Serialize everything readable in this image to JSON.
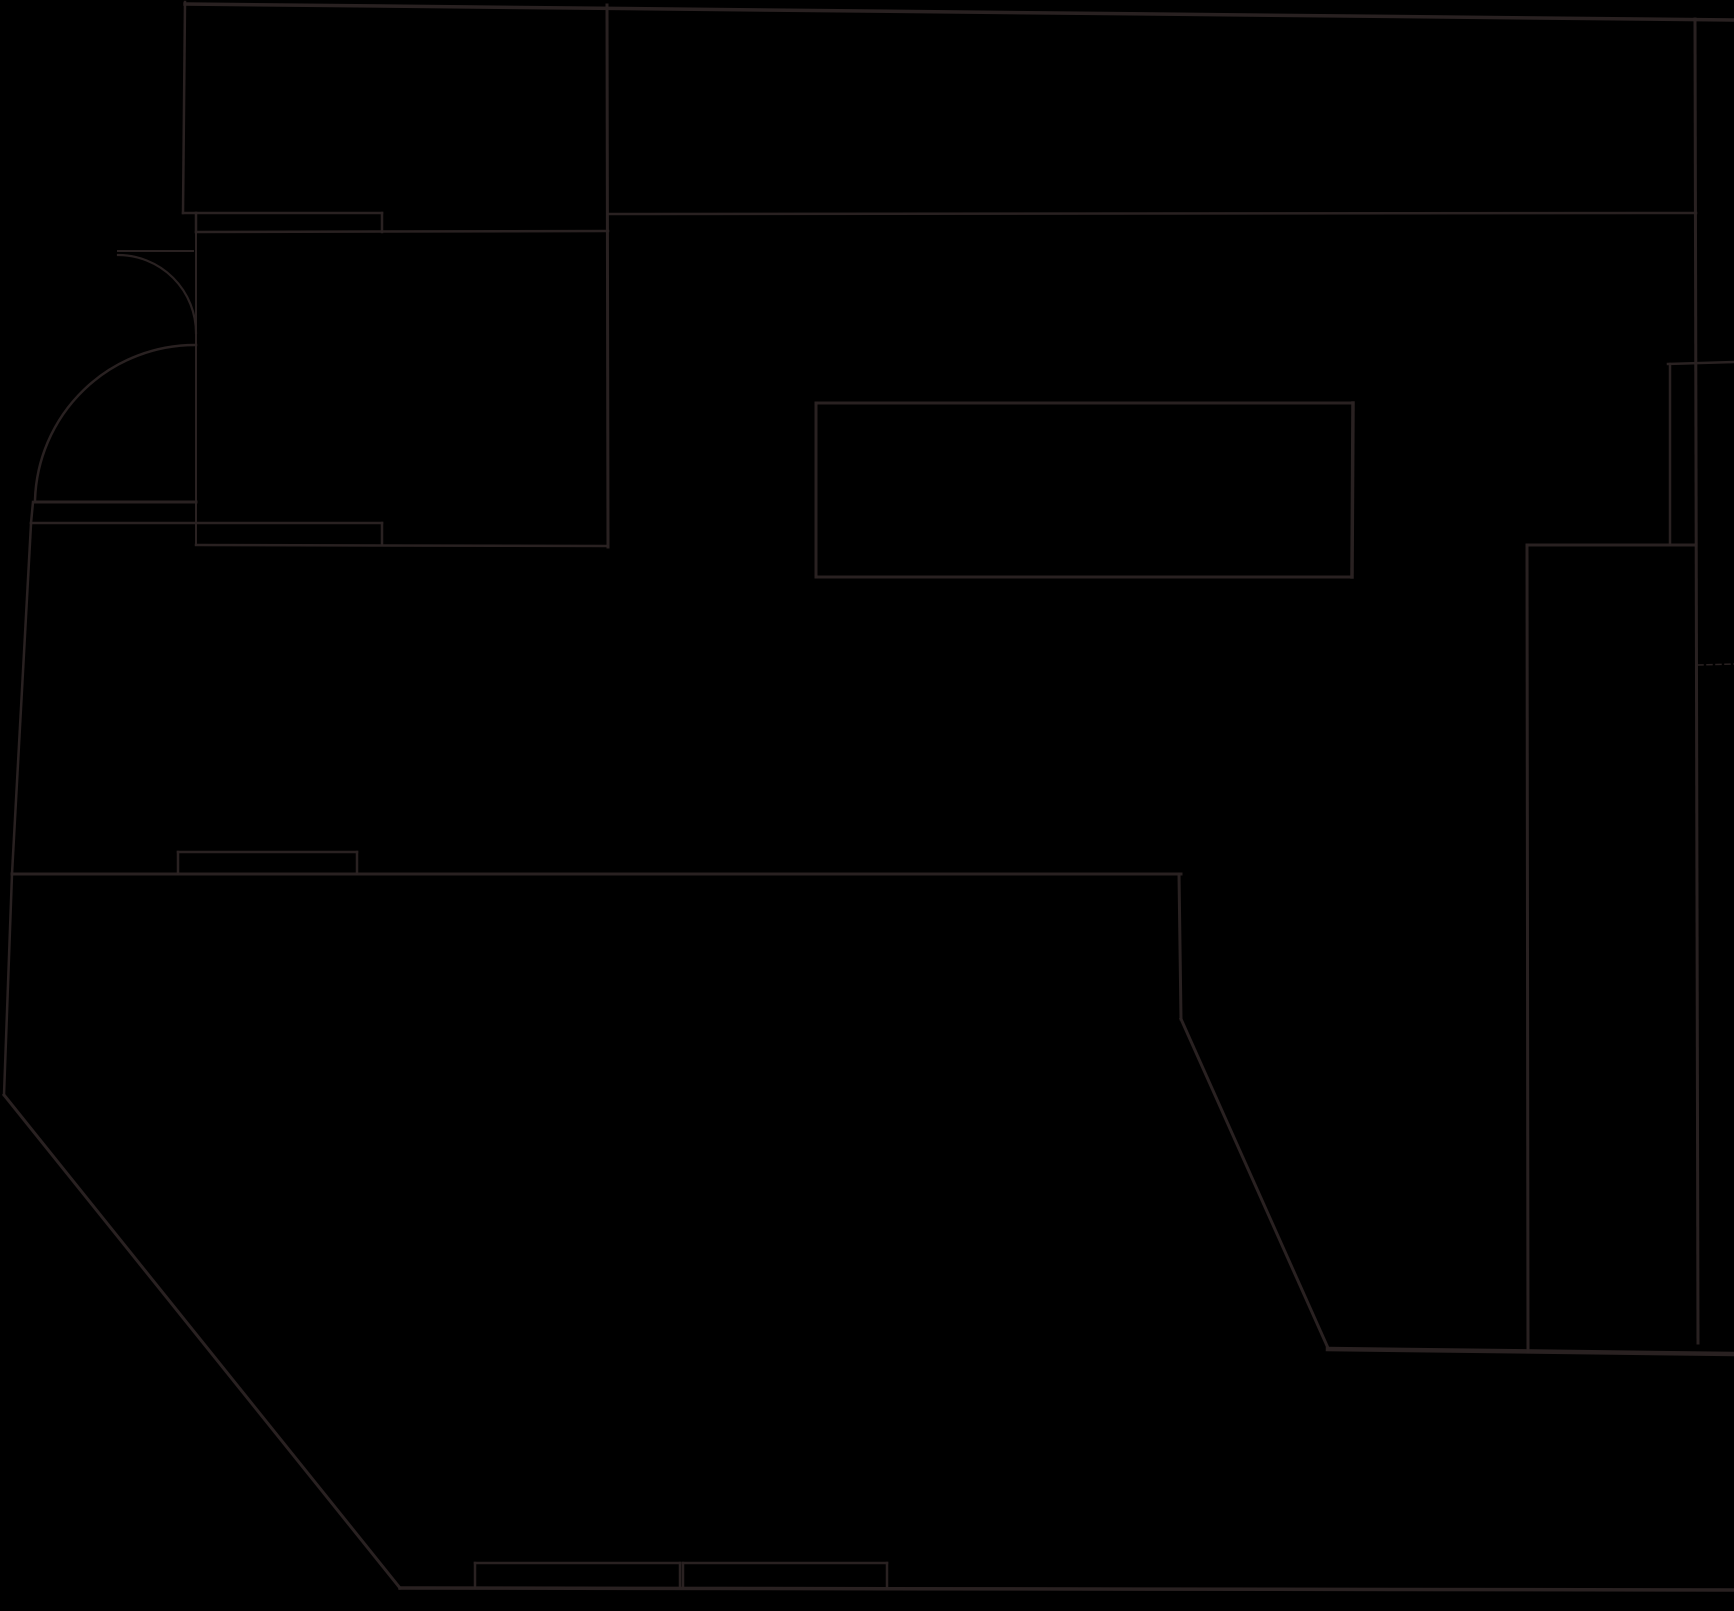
{
  "canvas": {
    "width": 1734,
    "height": 1611,
    "background_color": "#000000",
    "line_color": "#2b2222",
    "line_opacity": 0.96
  },
  "floor_plan": {
    "description": "single-line architectural floor plan, black background, faint dark strokes",
    "segments": [
      {
        "id": "upper-left-room-left-wall",
        "x1": 185,
        "y1": 2,
        "x2": 183,
        "y2": 213,
        "w": 2.5
      },
      {
        "id": "upper-left-jog",
        "x1": 183,
        "y1": 213,
        "x2": 196,
        "y2": 213,
        "w": 2.5
      },
      {
        "id": "window1-top",
        "x1": 196,
        "y1": 213,
        "x2": 382,
        "y2": 213,
        "w": 2.5
      },
      {
        "id": "window1-left-cap",
        "x1": 196,
        "y1": 213,
        "x2": 196,
        "y2": 232,
        "w": 2.5
      },
      {
        "id": "window1-right-cap",
        "x1": 382,
        "y1": 213,
        "x2": 382,
        "y2": 232,
        "w": 2.5
      },
      {
        "id": "wall-y231",
        "x1": 196,
        "y1": 232,
        "x2": 608,
        "y2": 231,
        "w": 2.5
      },
      {
        "id": "top-edge",
        "x1": 185,
        "y1": 4,
        "x2": 1734,
        "y2": 20,
        "w": 3.5
      },
      {
        "id": "vertical-607",
        "x1": 607,
        "y1": 5,
        "x2": 608,
        "y2": 547,
        "w": 3
      },
      {
        "id": "wall-y213-right",
        "x1": 608,
        "y1": 214,
        "x2": 1696,
        "y2": 213,
        "w": 2.5
      },
      {
        "id": "entry-wall-vertical-196",
        "x1": 196,
        "y1": 232,
        "x2": 196,
        "y2": 523,
        "w": 2
      },
      {
        "id": "door-leaf-upper",
        "x1": 118,
        "y1": 251,
        "x2": 193,
        "y2": 251,
        "w": 2
      },
      {
        "id": "entry-floor-y502",
        "x1": 35,
        "y1": 502,
        "x2": 196,
        "y2": 502,
        "w": 3
      },
      {
        "id": "entry-left-vertical",
        "x1": 33,
        "y1": 502,
        "x2": 31,
        "y2": 523,
        "w": 2.5
      },
      {
        "id": "wall-y523",
        "x1": 31,
        "y1": 523,
        "x2": 382,
        "y2": 523,
        "w": 2.5
      },
      {
        "id": "window2-mid-cap",
        "x1": 196,
        "y1": 523,
        "x2": 196,
        "y2": 545,
        "w": 2
      },
      {
        "id": "window2-right-cap",
        "x1": 382,
        "y1": 523,
        "x2": 382,
        "y2": 545,
        "w": 2.5
      },
      {
        "id": "wall-y545",
        "x1": 196,
        "y1": 545,
        "x2": 608,
        "y2": 546,
        "w": 2.5
      },
      {
        "id": "left-outer-wall-mid",
        "x1": 31,
        "y1": 524,
        "x2": 12,
        "y2": 874,
        "w": 2.5
      },
      {
        "id": "main-horizontal-y874",
        "x1": 12,
        "y1": 874,
        "x2": 1181,
        "y2": 874,
        "w": 3
      },
      {
        "id": "window3-top",
        "x1": 178,
        "y1": 852,
        "x2": 357,
        "y2": 852,
        "w": 2.5
      },
      {
        "id": "window3-left-cap",
        "x1": 178,
        "y1": 852,
        "x2": 178,
        "y2": 874,
        "w": 2.5
      },
      {
        "id": "window3-right-cap",
        "x1": 357,
        "y1": 852,
        "x2": 357,
        "y2": 874,
        "w": 2.5
      },
      {
        "id": "left-outer-wall-low",
        "x1": 12,
        "y1": 874,
        "x2": 4,
        "y2": 1095,
        "w": 2.5
      },
      {
        "id": "southwest-diagonal",
        "x1": 4,
        "y1": 1095,
        "x2": 400,
        "y2": 1588,
        "w": 3
      },
      {
        "id": "bottom-wall",
        "x1": 400,
        "y1": 1588,
        "x2": 1734,
        "y2": 1590,
        "w": 3.5
      },
      {
        "id": "window4-top",
        "x1": 475,
        "y1": 1563,
        "x2": 680,
        "y2": 1563,
        "w": 2.5
      },
      {
        "id": "window4-left-cap",
        "x1": 475,
        "y1": 1563,
        "x2": 475,
        "y2": 1588,
        "w": 2.5
      },
      {
        "id": "window4-right-cap",
        "x1": 680,
        "y1": 1563,
        "x2": 680,
        "y2": 1588,
        "w": 2.5
      },
      {
        "id": "window5-top",
        "x1": 683,
        "y1": 1563,
        "x2": 887,
        "y2": 1563,
        "w": 2.5
      },
      {
        "id": "window5-left-cap",
        "x1": 683,
        "y1": 1563,
        "x2": 683,
        "y2": 1588,
        "w": 2.5
      },
      {
        "id": "window5-right-cap",
        "x1": 887,
        "y1": 1563,
        "x2": 887,
        "y2": 1588,
        "w": 2.5
      },
      {
        "id": "vertical-1181",
        "x1": 1179,
        "y1": 874,
        "x2": 1181,
        "y2": 1019,
        "w": 3
      },
      {
        "id": "southeast-diagonal",
        "x1": 1181,
        "y1": 1019,
        "x2": 1328,
        "y2": 1348,
        "w": 3
      },
      {
        "id": "lower-right-horizontal-y1352",
        "x1": 1328,
        "y1": 1349,
        "x2": 1734,
        "y2": 1354,
        "w": 4.5
      },
      {
        "id": "center-rect-top",
        "x1": 816,
        "y1": 403,
        "x2": 1353,
        "y2": 403,
        "w": 3
      },
      {
        "id": "center-rect-right",
        "x1": 1353,
        "y1": 403,
        "x2": 1352,
        "y2": 577,
        "w": 3.5
      },
      {
        "id": "center-rect-bottom",
        "x1": 816,
        "y1": 577,
        "x2": 1352,
        "y2": 577,
        "w": 3
      },
      {
        "id": "center-rect-left",
        "x1": 816,
        "y1": 403,
        "x2": 816,
        "y2": 577,
        "w": 3
      },
      {
        "id": "right-outer-vertical-1696",
        "x1": 1695,
        "y1": 19,
        "x2": 1698,
        "y2": 1343,
        "w": 3
      },
      {
        "id": "right-strip-top",
        "x1": 1668,
        "y1": 364,
        "x2": 1734,
        "y2": 362,
        "w": 2.5
      },
      {
        "id": "right-strip-left",
        "x1": 1670,
        "y1": 364,
        "x2": 1670,
        "y2": 545,
        "w": 2.5
      },
      {
        "id": "right-room-top",
        "x1": 1527,
        "y1": 545,
        "x2": 1696,
        "y2": 545,
        "w": 3
      },
      {
        "id": "right-room-left",
        "x1": 1527,
        "y1": 545,
        "x2": 1528,
        "y2": 1352,
        "w": 3
      }
    ],
    "dashed_segments": [
      {
        "id": "right-dashed-tick",
        "x1": 1698,
        "y1": 665,
        "x2": 1734,
        "y2": 664,
        "w": 1.5,
        "dash": "5 4"
      }
    ],
    "arcs": [
      {
        "id": "door-swing-upper",
        "d": "M 118,255 A 78,78 0 0 1 196,333",
        "w": 2.2
      },
      {
        "id": "door-swing-lower",
        "d": "M 196,345 A 160,160 0 0 0 35,500",
        "w": 2.5
      }
    ]
  }
}
